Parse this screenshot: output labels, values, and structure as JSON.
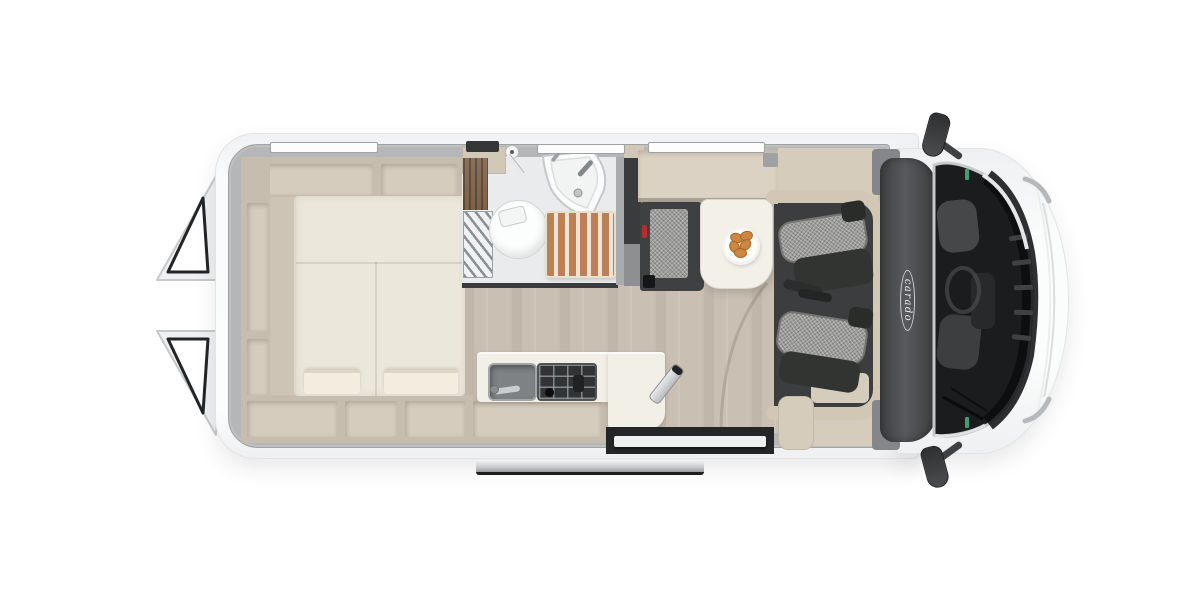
{
  "meta": {
    "type": "camper-van-floorplan",
    "view": "top-down interior cutaway with open rear doors"
  },
  "brand": {
    "logo_text": "carado"
  },
  "colors": {
    "bg": "#ffffff",
    "body-white": "#f7f8f9",
    "body-edge": "#e2e3e5",
    "wall-gray": "#b4b6b8",
    "cabinet-wall": "#c7bdae",
    "cabinet-interior": "#d6ccbd",
    "trim-beige": "#d2c6b4",
    "shelf-beige": "#d6ccbc",
    "mattress": "#ece7db",
    "pillow": "#f2edde",
    "wood-floor": "#c9bfb3",
    "wardrobe-wood": "#7d6149",
    "bath-floor": "#e9ebec",
    "teak": "#bd7f53",
    "counter": "#f2efe7",
    "hob-dark": "#313335",
    "bench-dark": "#3e4042",
    "fabric-gray": "#9c9c9a",
    "seat-dark": "#323432",
    "cab-band": "#47494b",
    "glass": "#1a1c1e",
    "belt-red": "#b23028",
    "sticker-green": "#3f9e6e",
    "croissant": "#cd8742",
    "rail-metal": "#c9cacb"
  },
  "objects": {
    "rear_bedroom": [
      "open-rear-doors",
      "overhead-storage-shelves",
      "transverse-double-bed",
      "bed-pillows",
      "lower-storage-lockers"
    ],
    "bathroom": [
      "toilet",
      "corner-washbasin",
      "shower-teak-grate",
      "folding-shower-screen",
      "wardrobe"
    ],
    "kitchen": [
      "kitchen-sink",
      "two-burner-hob",
      "worktop",
      "storage-compartment",
      "folding-step"
    ],
    "dinette": [
      "bench-seat",
      "dining-table",
      "plate-with-pastries",
      "swivelled-driver-seat",
      "swivelled-passenger-seat"
    ],
    "cab": [
      "brand-logo",
      "windshield",
      "dashboard",
      "hood",
      "top-side-mirror",
      "bottom-side-mirror",
      "sliding-door-rail",
      "entry-step"
    ]
  }
}
